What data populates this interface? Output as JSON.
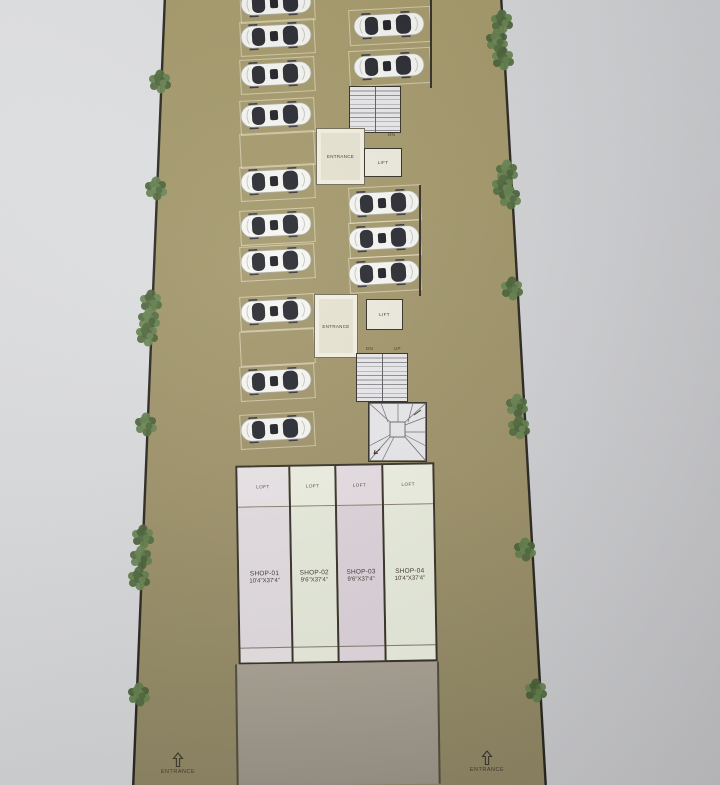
{
  "plan_title": "ground floor site plan",
  "colors": {
    "background_gray": "#d6d7d9",
    "plot_tan_top": "#a59968",
    "plot_tan_bottom": "#8f8663",
    "boundary_dark": "#26231d",
    "tree_green": "#54703f",
    "car_body": "#f5f5f3",
    "car_glass": "#24242c",
    "stair_fill": "#e9e9ec",
    "entrance_room_fill": "#e7e3d1",
    "lift_fill": "#edeadd",
    "shop1_fill": "#e4dee2",
    "shop2_fill": "#e8ecdc",
    "shop3_fill": "#ded5dc",
    "shop4_fill": "#eaeede",
    "platform_gray": "#a49c8e"
  },
  "shops": [
    {
      "name": "SHOP-01",
      "size": "10'4\"X37'4\"",
      "loft": "LOFT"
    },
    {
      "name": "SHOP-02",
      "size": "9'6\"X37'4\"",
      "loft": "LOFT"
    },
    {
      "name": "SHOP-03",
      "size": "9'6\"X37'4\"",
      "loft": "LOFT"
    },
    {
      "name": "SHOP-04",
      "size": "10'4\"X37'4\"",
      "loft": "LOFT"
    }
  ],
  "stair_blocks": {
    "upper": {
      "entrance_label": "ENTRANCE",
      "lift_label": "LIFT",
      "left_label": "UP",
      "right_label": "DN"
    },
    "lower": {
      "entrance_label": "ENTRANCE",
      "lift_label": "LIFT",
      "left_label": "DN",
      "right_label": "UP"
    }
  },
  "site": {
    "entrance_left_label": "ENTRANCE",
    "entrance_right_label": "ENTRANCE",
    "boundary": {
      "left": [
        165,
        -5,
        133,
        790
      ],
      "right": [
        501,
        -5,
        546,
        790
      ]
    },
    "trees_left": [
      [
        160,
        81
      ],
      [
        156,
        188
      ],
      [
        151,
        301
      ],
      [
        149,
        319
      ],
      [
        147,
        334
      ],
      [
        146,
        424
      ],
      [
        143,
        536
      ],
      [
        141,
        557
      ],
      [
        139,
        578
      ],
      [
        139,
        694
      ]
    ],
    "trees_right": [
      [
        502,
        21
      ],
      [
        497,
        40
      ],
      [
        503,
        58
      ],
      [
        507,
        171
      ],
      [
        503,
        186
      ],
      [
        510,
        197
      ],
      [
        512,
        288
      ],
      [
        517,
        405
      ],
      [
        519,
        427
      ],
      [
        525,
        549
      ],
      [
        536,
        690
      ]
    ]
  },
  "parking": {
    "left_column": {
      "x": 276,
      "stall_w": 73,
      "stall_h": 33,
      "stalls": [
        {
          "y": 3,
          "car": true
        },
        {
          "y": 36,
          "car": true
        },
        {
          "y": 74,
          "car": true
        },
        {
          "y": 115,
          "car": true
        },
        {
          "y": 148,
          "car": false
        },
        {
          "y": 181,
          "car": true
        },
        {
          "y": 225,
          "car": true
        },
        {
          "y": 261,
          "car": true
        },
        {
          "y": 311,
          "car": true
        },
        {
          "y": 346,
          "car": false
        },
        {
          "y": 381,
          "car": true
        },
        {
          "y": 429,
          "car": true
        }
      ]
    },
    "right_top": {
      "x": 389,
      "stall_w": 80,
      "stall_h": 34,
      "stalls": [
        {
          "y": 25,
          "car": true
        },
        {
          "y": 66,
          "car": true
        }
      ]
    },
    "right_mid": {
      "x": 384,
      "stall_w": 70,
      "stall_h": 34,
      "stalls": [
        {
          "y": 203,
          "car": true
        },
        {
          "y": 238,
          "car": true
        },
        {
          "y": 273,
          "car": true
        }
      ]
    }
  }
}
